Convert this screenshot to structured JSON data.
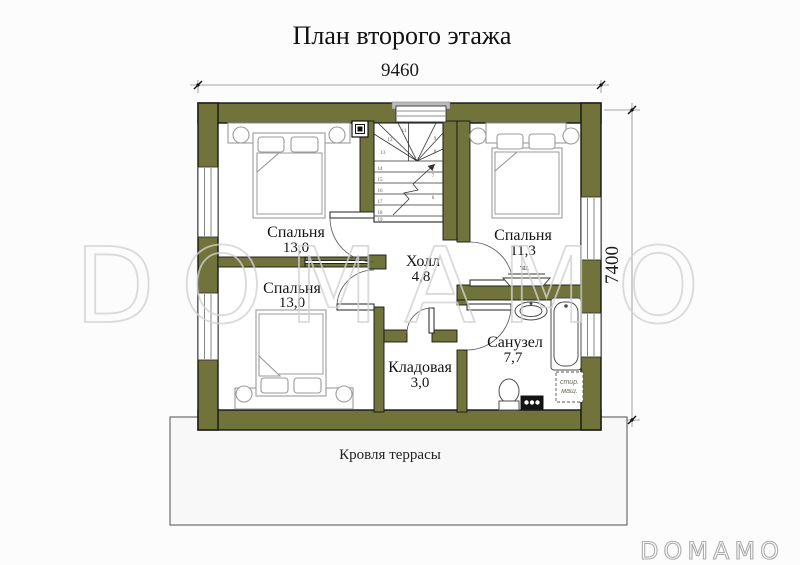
{
  "title": "План второго этажа",
  "dims": {
    "width": "9460",
    "depth": "7400"
  },
  "rooms": {
    "bedroom_top_left": {
      "name": "Спальня",
      "area": "13,0"
    },
    "bedroom_bottom_left": {
      "name": "Спальня",
      "area": "13,0"
    },
    "bedroom_right": {
      "name": "Спальня",
      "area": "11,3"
    },
    "hall": {
      "name": "Холл",
      "area": "4,8"
    },
    "storage": {
      "name": "Кладовая",
      "area": "3,0"
    },
    "bathroom": {
      "name": "Санузел",
      "area": "7,7"
    }
  },
  "annotations": {
    "terrace": "Кровля террасы",
    "washer_line1": "стир.",
    "washer_line2": "маш.",
    "tv": "тв."
  },
  "stairs": {
    "winders": [
      "11",
      "12",
      "13"
    ],
    "left": [
      "14",
      "15",
      "16",
      "17",
      "18",
      "19"
    ],
    "right": [
      "9",
      "8",
      "7",
      "6"
    ]
  },
  "watermark": "DOMAMO",
  "logo": "DOMAMO",
  "colors": {
    "wall_color": "#70743a",
    "terrace_color": "#f8f8f8",
    "watermark_color": "#d2d2d2"
  }
}
